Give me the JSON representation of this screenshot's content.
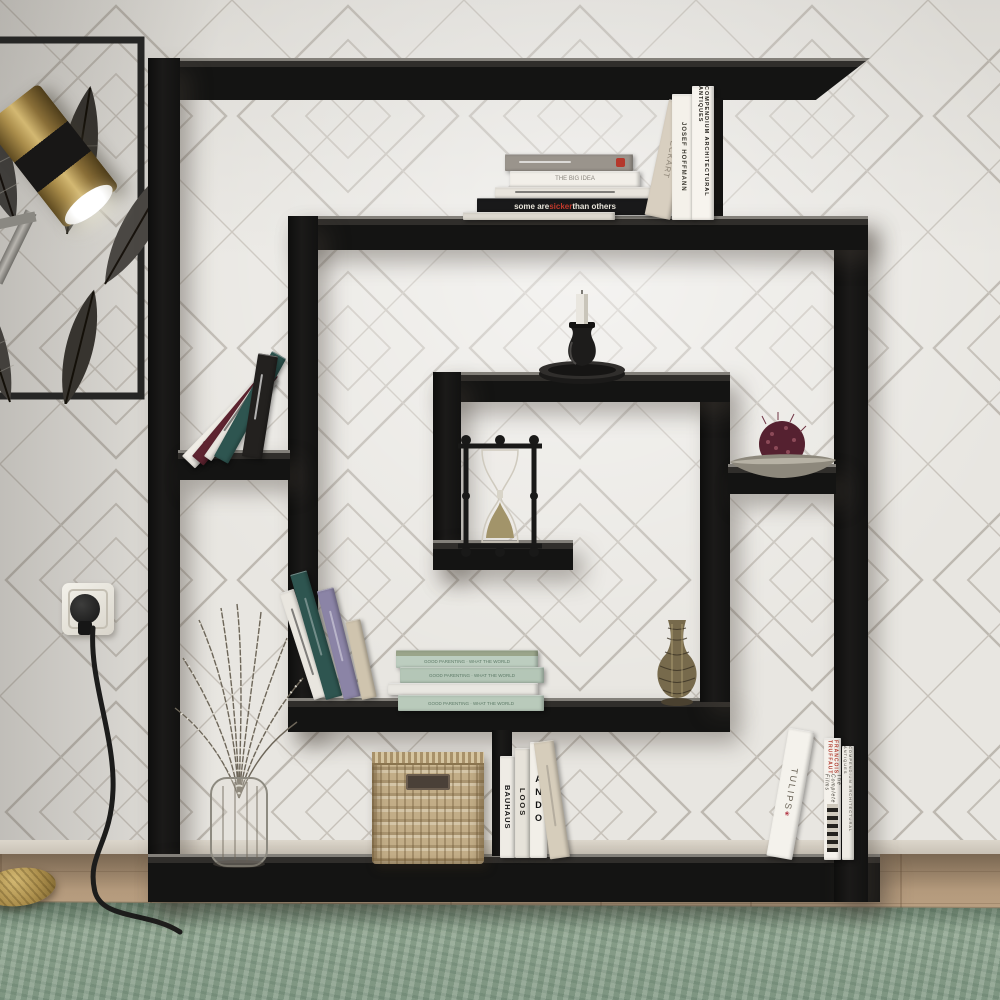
{
  "palette": {
    "shelf_black": "#141413",
    "wallpaper_base": "#e8e6e1",
    "wallpaper_line": "#bdb8b0",
    "wood_floor": "#b59b7d",
    "rug_green": "#8ea692",
    "brass_gold": "#a98c4a",
    "wicker_tan": "#c6b18d",
    "book_green": "#bccdbf",
    "accent_red": "#c0392b",
    "candle_white": "#e9e6df",
    "pomander_maroon": "#5a2330"
  },
  "books": {
    "top_stack": [
      {
        "title": "",
        "color": "#9a948c"
      },
      {
        "title": "THE BIG IDEA",
        "color": "#f2efe9"
      },
      {
        "title": "",
        "color": "#e8e4dc"
      },
      {
        "title_pre": "some are ",
        "title_highlight": "sicker",
        "title_post": " than others",
        "color": "#19191a"
      },
      {
        "title": "",
        "color": "#ddd9d0"
      }
    ],
    "top_right": [
      {
        "title": "ECKART",
        "color": "#d8cfc0"
      },
      {
        "title": "JOSEF HOFFMANN",
        "color": "#f4f1ea"
      },
      {
        "title": "COMPENDIUM ARCHITECTURAL ANTIQUES",
        "color": "#f7f4ee"
      }
    ],
    "middle_left": [
      {
        "title": "Fashion Branding",
        "color": "#f0ede6"
      },
      {
        "title": "",
        "color": "#5e2430"
      },
      {
        "title": "",
        "color": "#e8e5de"
      },
      {
        "title": "",
        "color": "#2e5550"
      },
      {
        "title": "",
        "color": "#23211f"
      }
    ],
    "lower_left": [
      {
        "title": "",
        "color": "#e9e6df"
      },
      {
        "title": "",
        "color": "#2e5550"
      },
      {
        "title": "",
        "color": "#8b84a6"
      },
      {
        "title": "",
        "color": "#cfc4ae"
      }
    ],
    "green_stack": [
      {
        "title": "GOOD PARENTING · WHAT THE WORLD",
        "color": "#bccdbf"
      },
      {
        "title": "GOOD PARENTING · WHAT THE WORLD",
        "color": "#bccdbf"
      },
      {
        "title": "",
        "color": "#e9e7e1"
      },
      {
        "title": "GOOD PARENTING · WHAT THE WORLD",
        "color": "#bccdbf"
      }
    ],
    "bottom_center": [
      {
        "title": "BAUHAUS",
        "color": "#efece5"
      },
      {
        "title": "LOOS",
        "color": "#e6e2d9"
      },
      {
        "title": "ANDO",
        "color": "#f2efe8"
      },
      {
        "title": "",
        "color": "#d6cdbb"
      }
    ],
    "bottom_right": [
      {
        "title": "TULIPS",
        "color": "#f4f2ec"
      },
      {
        "title": "FRANCOIS TRUFFAUT",
        "subtitle": "The Complete Films",
        "color": "#f5f2ec"
      },
      {
        "title": "COMPENDIUM ARCHITECTURAL ANTIQUES",
        "color": "#eeebe4"
      }
    ]
  }
}
